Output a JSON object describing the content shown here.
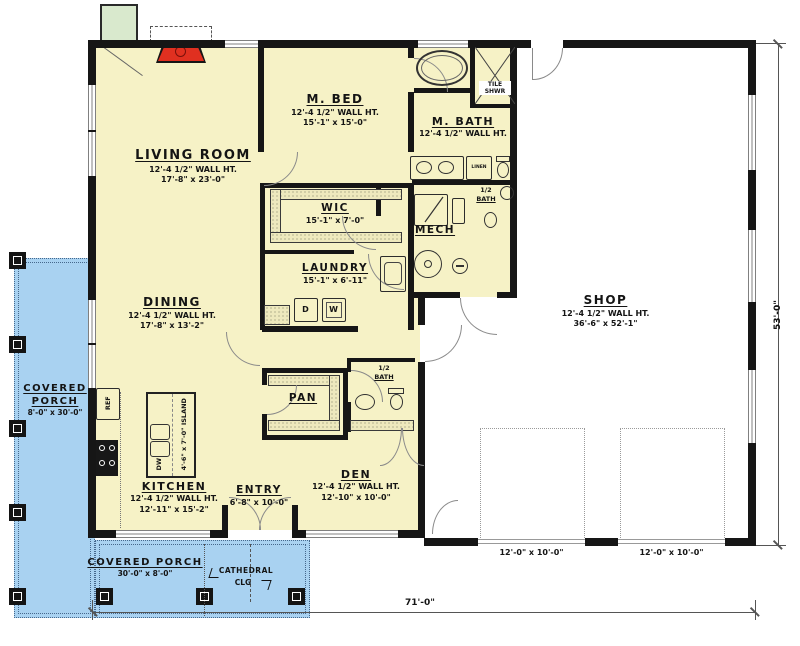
{
  "rooms": {
    "living": {
      "name": "LIVING ROOM",
      "wall": "12'-4 1/2\" WALL HT.",
      "size": "17'-8\" x 23'-0\""
    },
    "mbed": {
      "name": "M. BED",
      "wall": "12'-4 1/2\" WALL HT.",
      "size": "15'-1\" x 15'-0\""
    },
    "mbath": {
      "name": "M. BATH",
      "wall": "12'-4 1/2\" WALL HT."
    },
    "wic": {
      "name": "WIC",
      "size": "15'-1\" x 7'-0\""
    },
    "laundry": {
      "name": "LAUNDRY",
      "size": "15'-1\" x 6'-11\""
    },
    "dining": {
      "name": "DINING",
      "wall": "12'-4 1/2\" WALL HT.",
      "size": "17'-8\" x 13'-2\""
    },
    "kitchen": {
      "name": "KITCHEN",
      "wall": "12'-4 1/2\" WALL HT.",
      "size": "12'-11\" x 15'-2\""
    },
    "entry": {
      "name": "ENTRY",
      "size": "6'-8\" x 10'-0\""
    },
    "den": {
      "name": "DEN",
      "wall": "12'-4 1/2\" WALL HT.",
      "size": "12'-10\" x 10'-0\""
    },
    "shop": {
      "name": "SHOP",
      "wall": "12'-4 1/2\" WALL HT.",
      "size": "36'-6\" x 52'-1\""
    },
    "pan": {
      "name": "PAN"
    },
    "mech": {
      "name": "MECH"
    },
    "porch_left": {
      "name": "COVERED PORCH",
      "size": "8'-0\" x 30'-0\""
    },
    "porch_bottom": {
      "name": "COVERED PORCH",
      "size": "30'-0\" x 8'-0\""
    }
  },
  "small": {
    "tile1": "TILE",
    "tile2": "SHWR",
    "linen": "LINEN",
    "hb1": "1/2",
    "hb2": "BATH",
    "cath1": "CATHEDRAL",
    "cath2": "CLG",
    "ref": "REF",
    "dw": "DW",
    "d": "D",
    "w": "W",
    "island": "4'-6\" x 7'-0\" ISLAND"
  },
  "dims": {
    "width": "71'-0\"",
    "height": "53'-0\"",
    "garage1": "12'-0\" x 10'-0\"",
    "garage2": "12'-0\" x 10'-0\""
  },
  "colors": {
    "interior": "#f6f2c6",
    "porch": "#a9d2f1",
    "safe_room": "#d9e9cd",
    "wood_stove": "#e03020",
    "wall": "#161616"
  }
}
